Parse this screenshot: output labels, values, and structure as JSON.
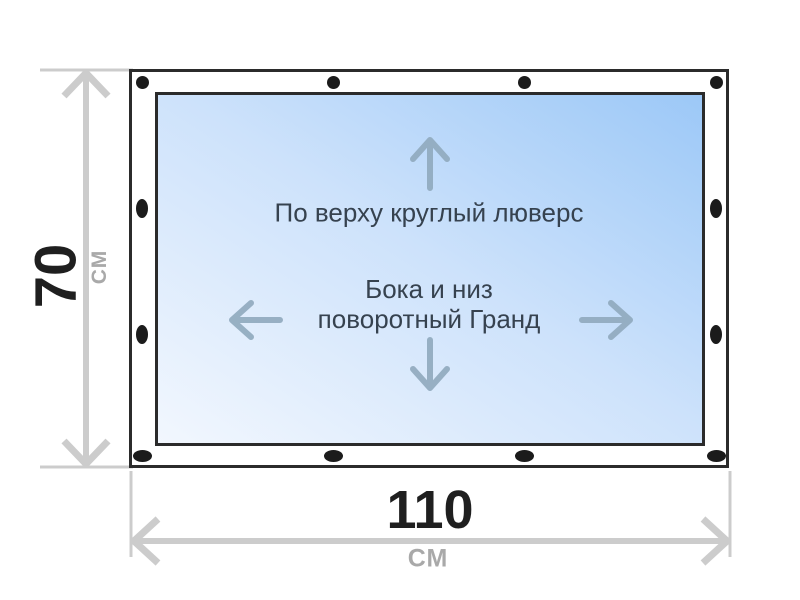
{
  "diagram": {
    "annotations": {
      "top_edge": "По верху круглый люверс",
      "sides_line1": "Бока и низ",
      "sides_line2": "поворотный Гранд"
    },
    "dimensions": {
      "height": {
        "value": "70",
        "unit": "СМ"
      },
      "width": {
        "value": "110",
        "unit": "СМ"
      }
    }
  },
  "theme": {
    "frame_border": "#2b2b2b",
    "grommet": "#1b1b1b",
    "panel_grad_light": "#f2f7fe",
    "panel_grad_mid": "#cde2fb",
    "panel_grad_deep": "#9cc8f7",
    "inner_text": "#36424f",
    "inner_arrow": "#8fa8bc",
    "dimension_line": "#cccccc",
    "dim_number": "#1f1f1f",
    "dim_unit": "#a9a9a9"
  }
}
